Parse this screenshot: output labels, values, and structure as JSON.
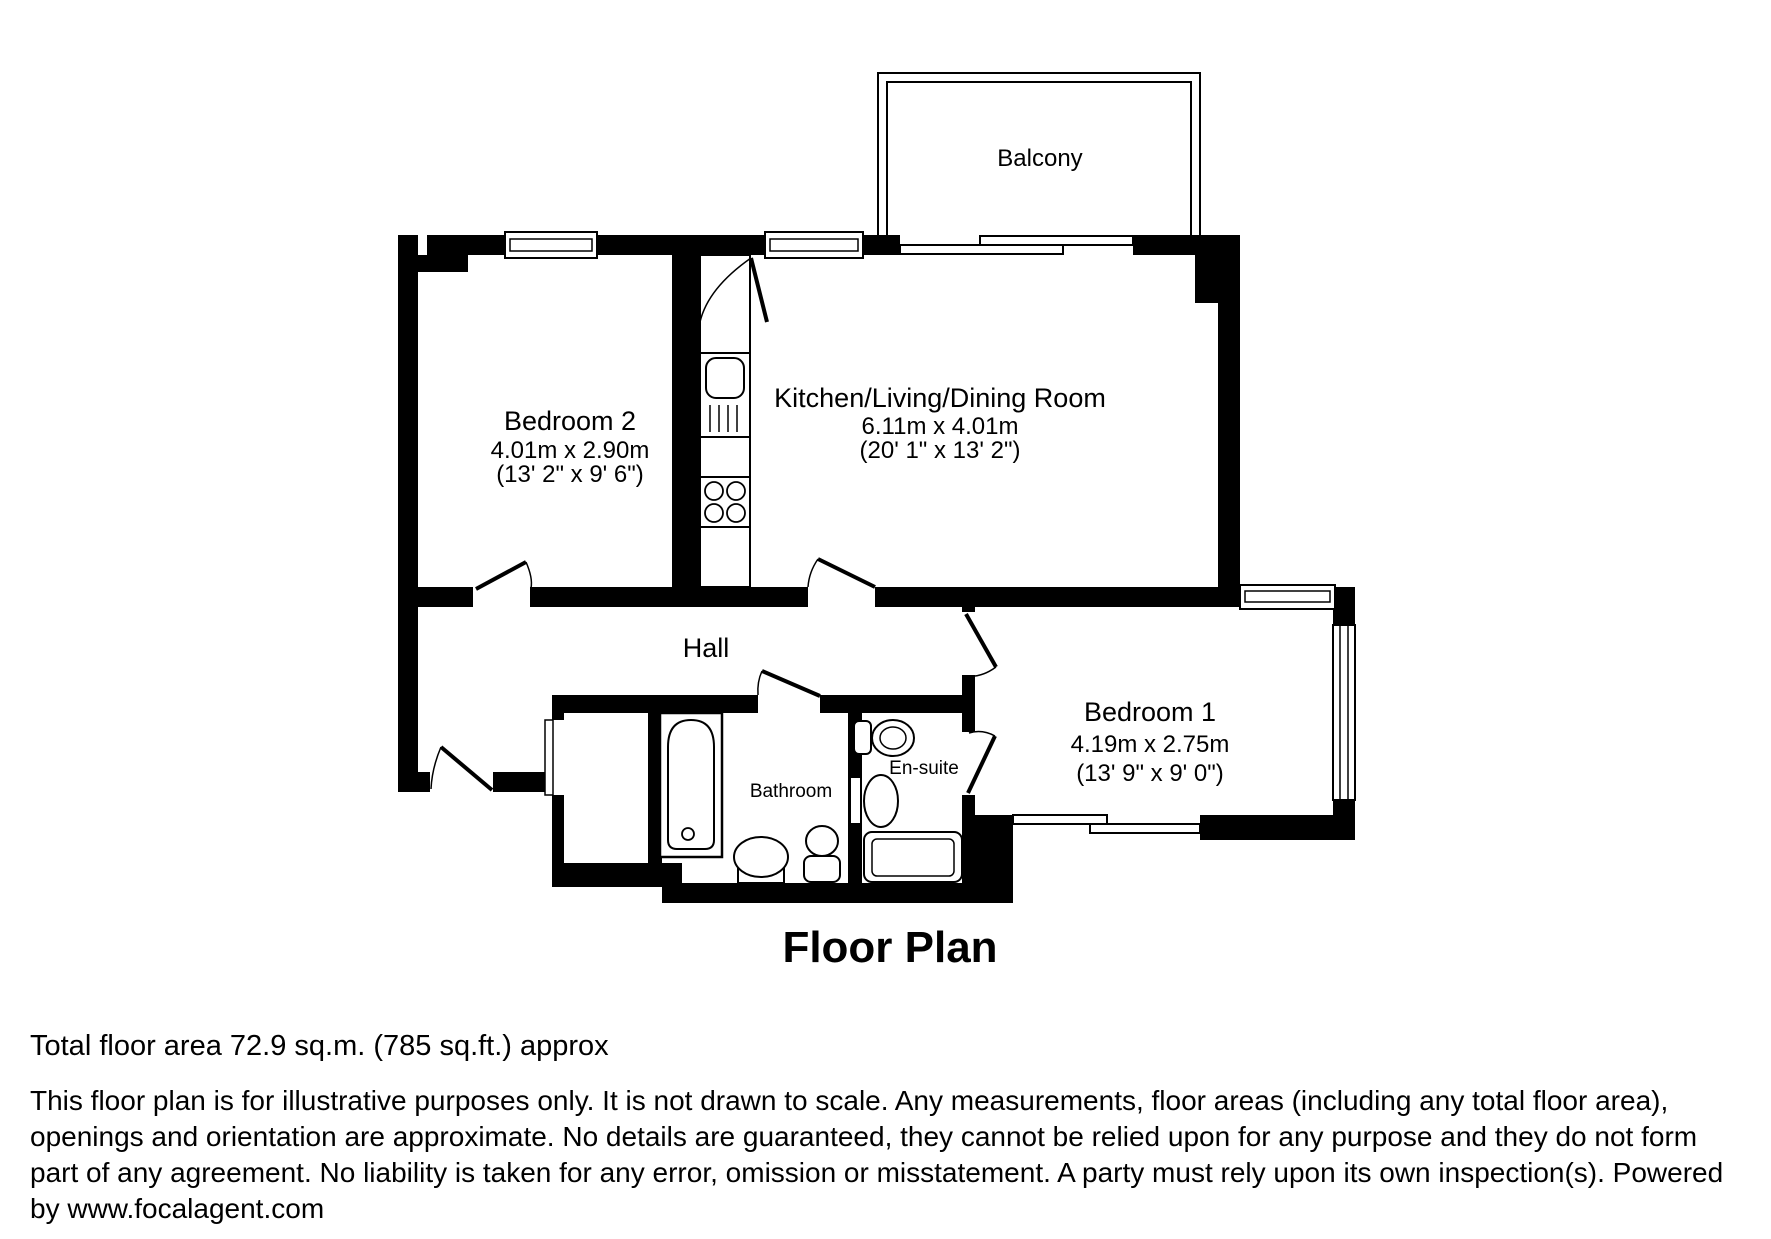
{
  "title": "Floor Plan",
  "colors": {
    "wall": "#000000",
    "background": "#ffffff"
  },
  "rooms": {
    "balcony": {
      "name": "Balcony"
    },
    "bedroom2": {
      "name": "Bedroom 2",
      "metric": "4.01m x 2.90m",
      "imperial": "(13' 2\" x 9' 6\")"
    },
    "kitchen": {
      "name": "Kitchen/Living/Dining Room",
      "metric": "6.11m x 4.01m",
      "imperial": "(20' 1\" x 13' 2\")"
    },
    "hall": {
      "name": "Hall"
    },
    "bathroom": {
      "name": "Bathroom"
    },
    "ensuite": {
      "name": "En-suite"
    },
    "bedroom1": {
      "name": "Bedroom 1",
      "metric": "4.19m x 2.75m",
      "imperial": "(13' 9\" x 9' 0\")"
    }
  },
  "footer": {
    "total_area": "Total floor area 72.9 sq.m. (785 sq.ft.) approx",
    "disclaimer": "This floor plan is for illustrative purposes only. It is not drawn to scale. Any measurements, floor areas (including any total floor area),\nopenings and orientation are approximate. No details are guaranteed, they cannot be relied upon for any purpose and they do not form\npart of any agreement. No liability is taken for any error, omission or misstatement. A party must rely upon its own inspection(s). Powered\nby www.focalagent.com"
  }
}
